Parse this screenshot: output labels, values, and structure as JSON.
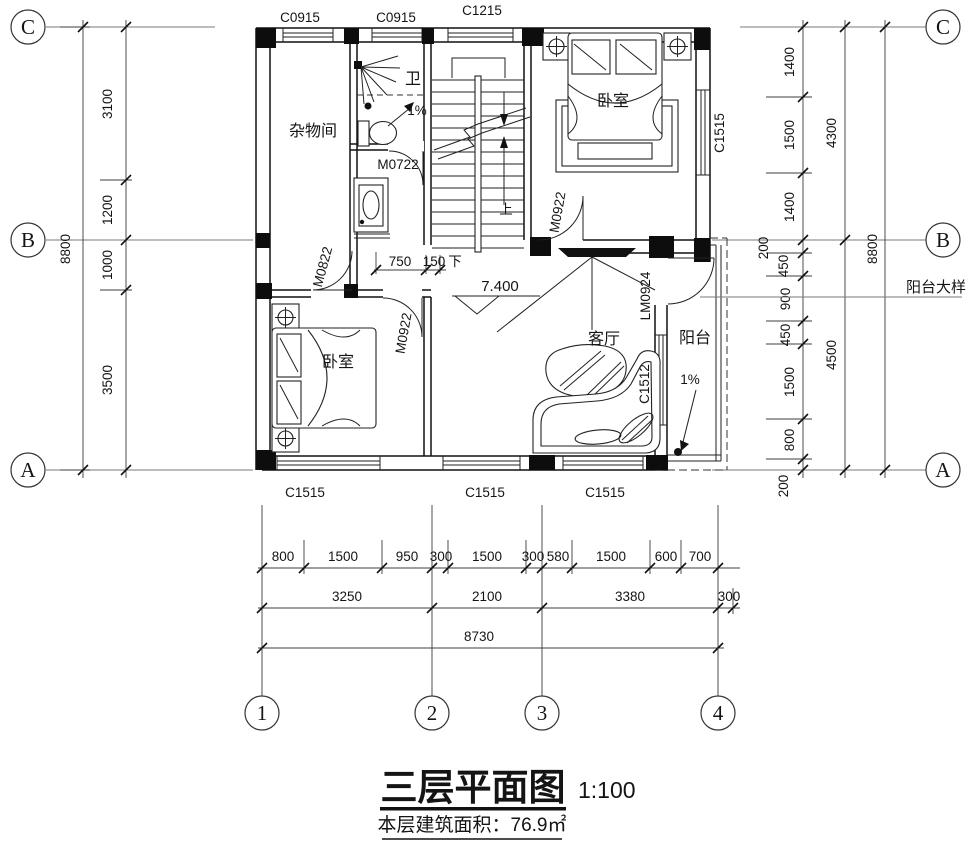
{
  "title": {
    "name": "三层平面图",
    "scale": "1:100",
    "area_note": "本层建筑面积：76.9㎡"
  },
  "grid": {
    "rows": [
      "C",
      "B",
      "A"
    ],
    "cols": [
      "1",
      "2",
      "3",
      "4"
    ]
  },
  "rooms": {
    "storage": "杂物间",
    "bath": "卫",
    "bedroom_top": "卧室",
    "bedroom_bottom": "卧室",
    "living": "客厅",
    "balcony": "阳台"
  },
  "doors": {
    "bath": "M0722",
    "storage": "M0822",
    "bedroom_bottom": "M0922",
    "bedroom_top": "M0922",
    "balcony": "LM0924"
  },
  "windows": {
    "top": [
      "C0915",
      "C0915",
      "C1215"
    ],
    "bottom": [
      "C1515",
      "C1515",
      "C1515"
    ],
    "right": "C1515",
    "balcony": "C1512"
  },
  "marks": {
    "level": "7.400",
    "slope_bath": "1%",
    "slope_balcony": "1%",
    "stair_up": "上",
    "stair_down": "下",
    "balcony_detail": "阳台大样"
  },
  "dims": {
    "left": {
      "segments": [
        "3100",
        "1200",
        "1000",
        "3500"
      ],
      "total": "8800"
    },
    "right": {
      "segments": [
        "1400",
        "1500",
        "1400",
        "200",
        "450",
        "900",
        "450",
        "1500",
        "800",
        "200"
      ],
      "mid": [
        "4300",
        "4500"
      ],
      "total": "8800"
    },
    "bottom": {
      "row1": [
        "800",
        "1500",
        "950",
        "300",
        "1500",
        "300",
        "580",
        "1500",
        "600",
        "700"
      ],
      "row2": [
        "3250",
        "2100",
        "3380",
        "300"
      ],
      "row3": "8730"
    },
    "stair": [
      "750",
      "150"
    ]
  }
}
